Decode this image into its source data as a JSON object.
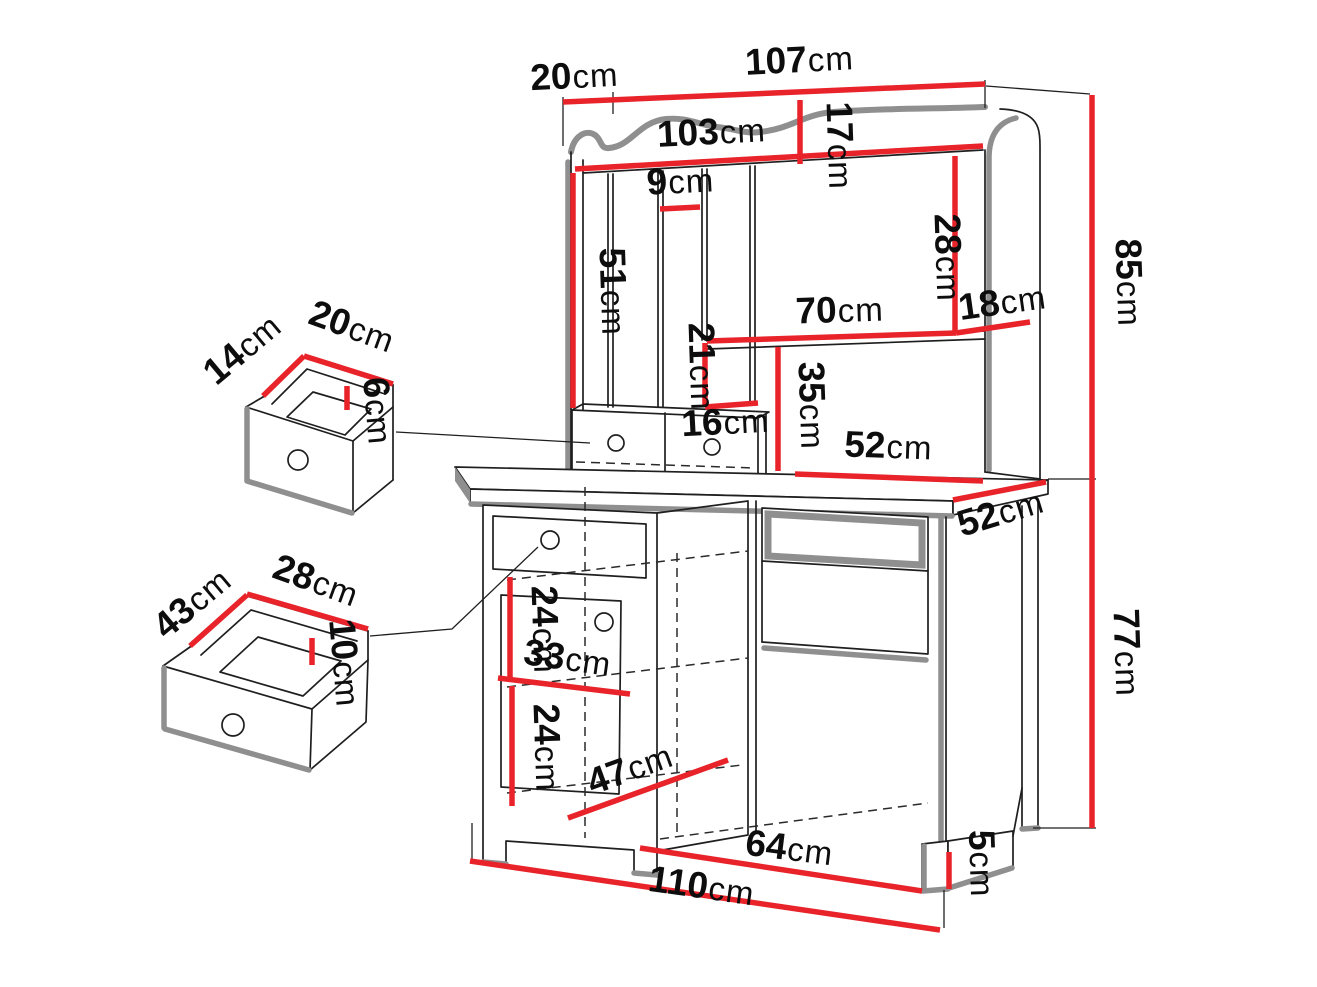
{
  "unit": "cm",
  "colors": {
    "dimension_red": "#e8232a",
    "outline_black": "#1f1f1f",
    "shadow_gray": "#8f8f8f",
    "background": "#ffffff"
  },
  "dimensions": {
    "hutch_top_depth": "20",
    "hutch_width": "107",
    "hutch_inner_width": "103",
    "crown_height": "17",
    "cubby_slot_width": "9",
    "left_cubby_height": "51",
    "right_cubby_height": "28",
    "shelf_length": "70",
    "right_cubby_width": "18",
    "hutch_height": "85",
    "niche_height": "21",
    "niche_width": "16",
    "open_section_height": "35",
    "shelf_clear_width": "52",
    "desktop_depth": "52",
    "desk_height": "77",
    "upper_shelf_gap": "24",
    "shelf_depth": "33",
    "lower_shelf_gap": "24",
    "floor_clear_depth": "47",
    "floor_clear_width": "64",
    "desk_width": "110",
    "leg_height": "5",
    "small_drawer_depth": "14",
    "small_drawer_width": "20",
    "small_drawer_height": "6",
    "large_drawer_depth": "43",
    "large_drawer_width": "28",
    "large_drawer_height": "10"
  }
}
